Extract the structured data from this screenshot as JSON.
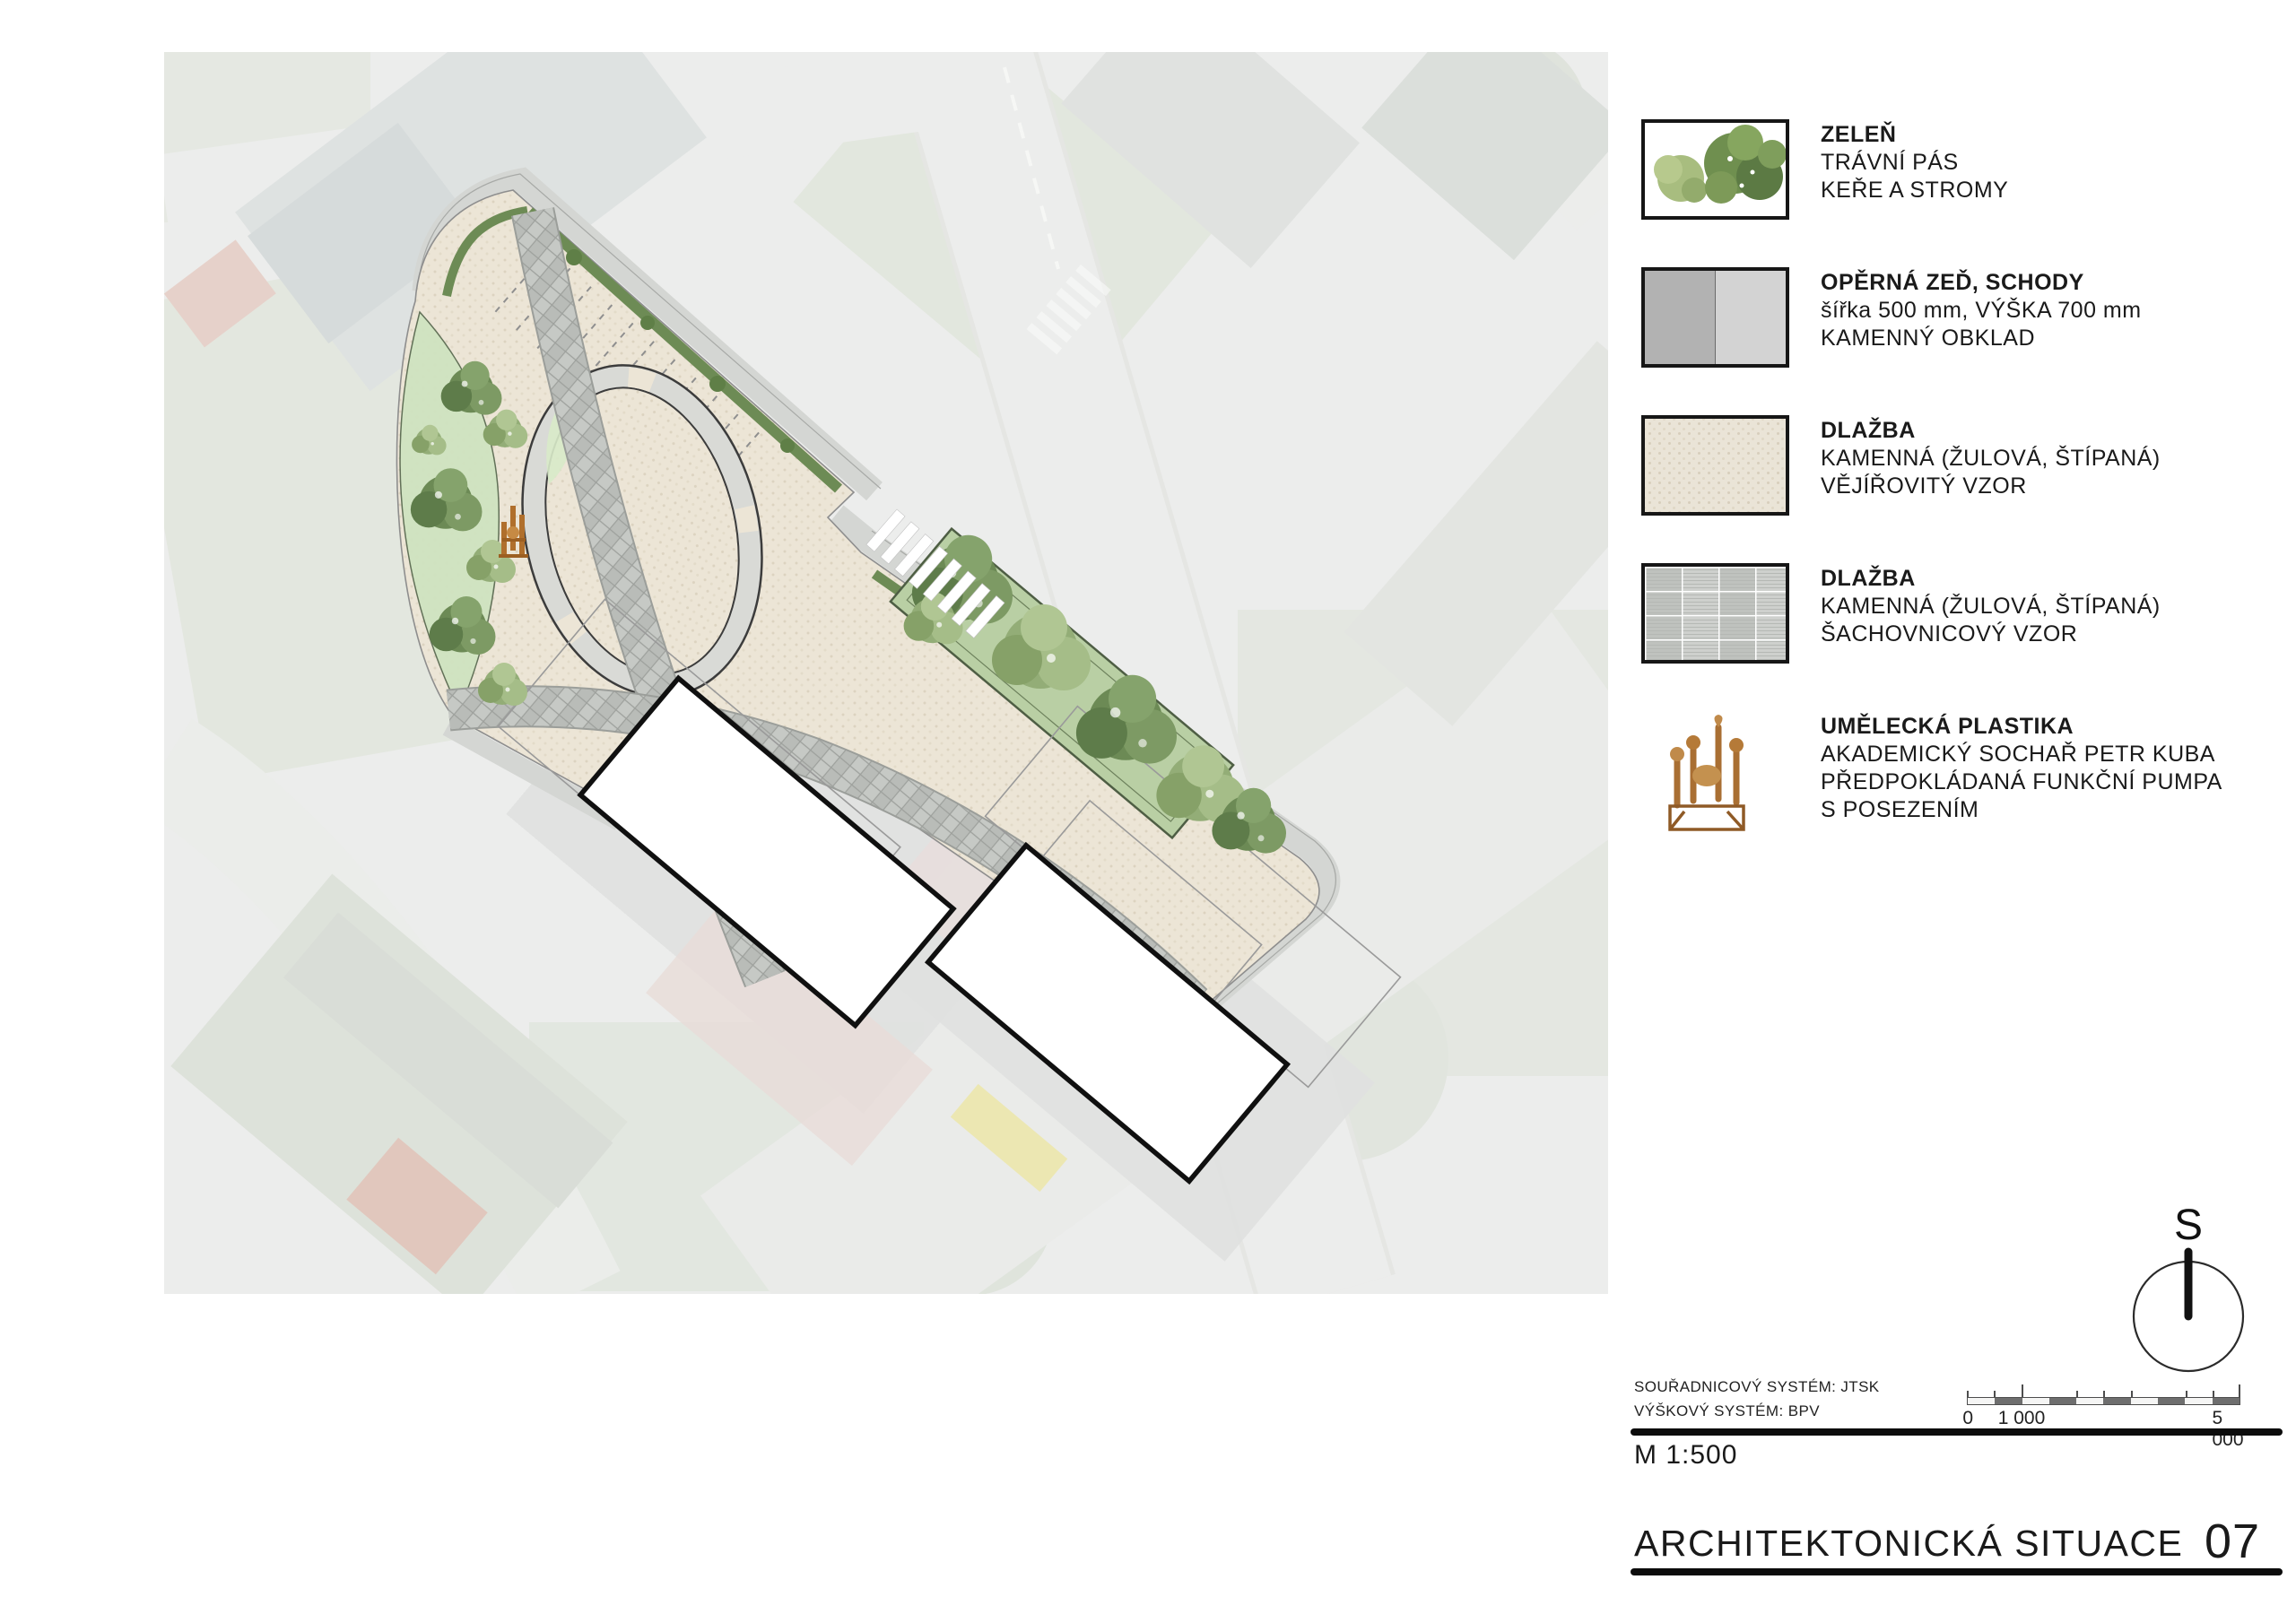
{
  "legend": {
    "items": [
      {
        "id": "zelen",
        "title": "ZELEŇ",
        "lines": [
          "TRÁVNÍ PÁS",
          "KEŘE A STROMY"
        ]
      },
      {
        "id": "operna-zed",
        "title": "OPĚRNÁ ZEĎ, SCHODY",
        "lines": [
          "šířka 500 mm, VÝŠKA 700 mm",
          "KAMENNÝ OBKLAD"
        ]
      },
      {
        "id": "dlazba-vejirovity",
        "title": "DLAŽBA",
        "lines": [
          "KAMENNÁ (ŽULOVÁ, ŠTÍPANÁ)",
          "VĚJÍŘOVITÝ VZOR"
        ]
      },
      {
        "id": "dlazba-sachovnicovy",
        "title": "DLAŽBA",
        "lines": [
          "KAMENNÁ (ŽULOVÁ, ŠTÍPANÁ)",
          "ŠACHOVNICOVÝ VZOR"
        ]
      },
      {
        "id": "umelecka-plastika",
        "title": "UMĚLECKÁ PLASTIKA",
        "lines": [
          "AKADEMICKÝ SOCHAŘ PETR KUBA",
          "PŘEDPOKLÁDANÁ FUNKČNÍ PUMPA",
          "S POSEZENÍM"
        ]
      }
    ]
  },
  "north": {
    "label": "S"
  },
  "scalebar": {
    "labels": [
      "0",
      "1 000",
      "5 000"
    ]
  },
  "systems": {
    "coordinate": "SOUŘADNICOVÝ SYSTÉM: JTSK",
    "height": "VÝŠKOVÝ SYSTÉM: BPV",
    "scale": "M 1:500"
  },
  "titleblock": {
    "title": "ARCHITEKTONICKÁ SITUACE",
    "sheet_number": "07"
  },
  "colors": {
    "paving_beige": "#ece5d6",
    "paving_gray": "#c5c8c4",
    "greenery": "#7b9a63",
    "wall_dark": "#b2b2b2",
    "wall_light": "#d3d3d3",
    "sculpture_orange": "#b06f2c"
  }
}
